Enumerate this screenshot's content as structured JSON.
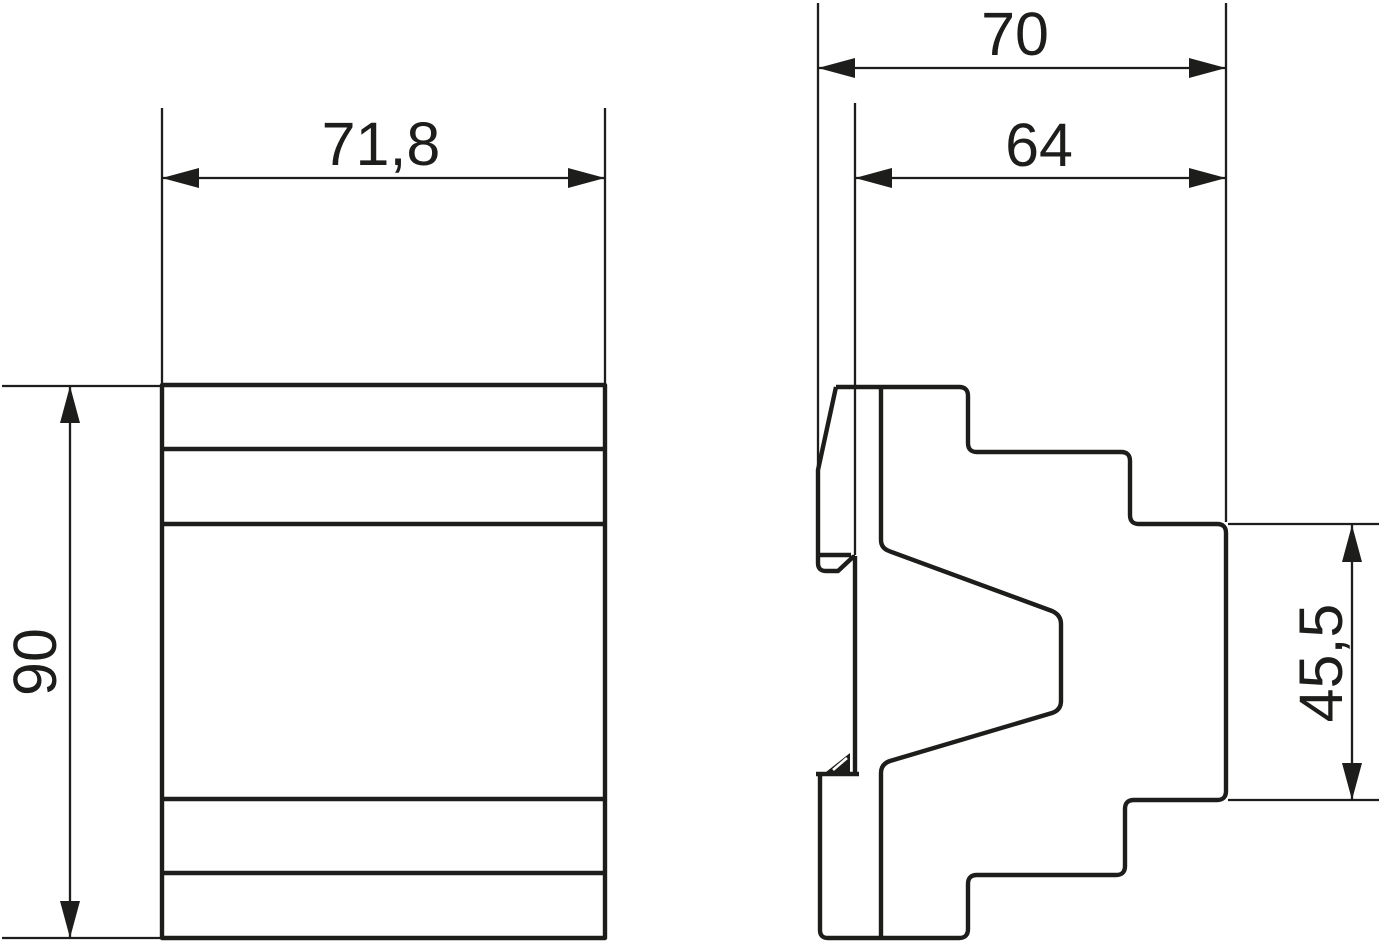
{
  "drawing": {
    "background": "#ffffff",
    "line_color": "#1d1d1b",
    "dimensions": {
      "front_width": {
        "label": "71,8",
        "value": 71.8,
        "orientation": "horizontal"
      },
      "front_height": {
        "label": "90",
        "value": 90,
        "orientation": "vertical"
      },
      "side_total_depth": {
        "label": "70",
        "value": 70,
        "orientation": "horizontal"
      },
      "side_body_depth": {
        "label": "64",
        "value": 64,
        "orientation": "horizontal"
      },
      "side_front_height": {
        "label": "45,5",
        "value": 45.5,
        "orientation": "vertical"
      }
    }
  }
}
